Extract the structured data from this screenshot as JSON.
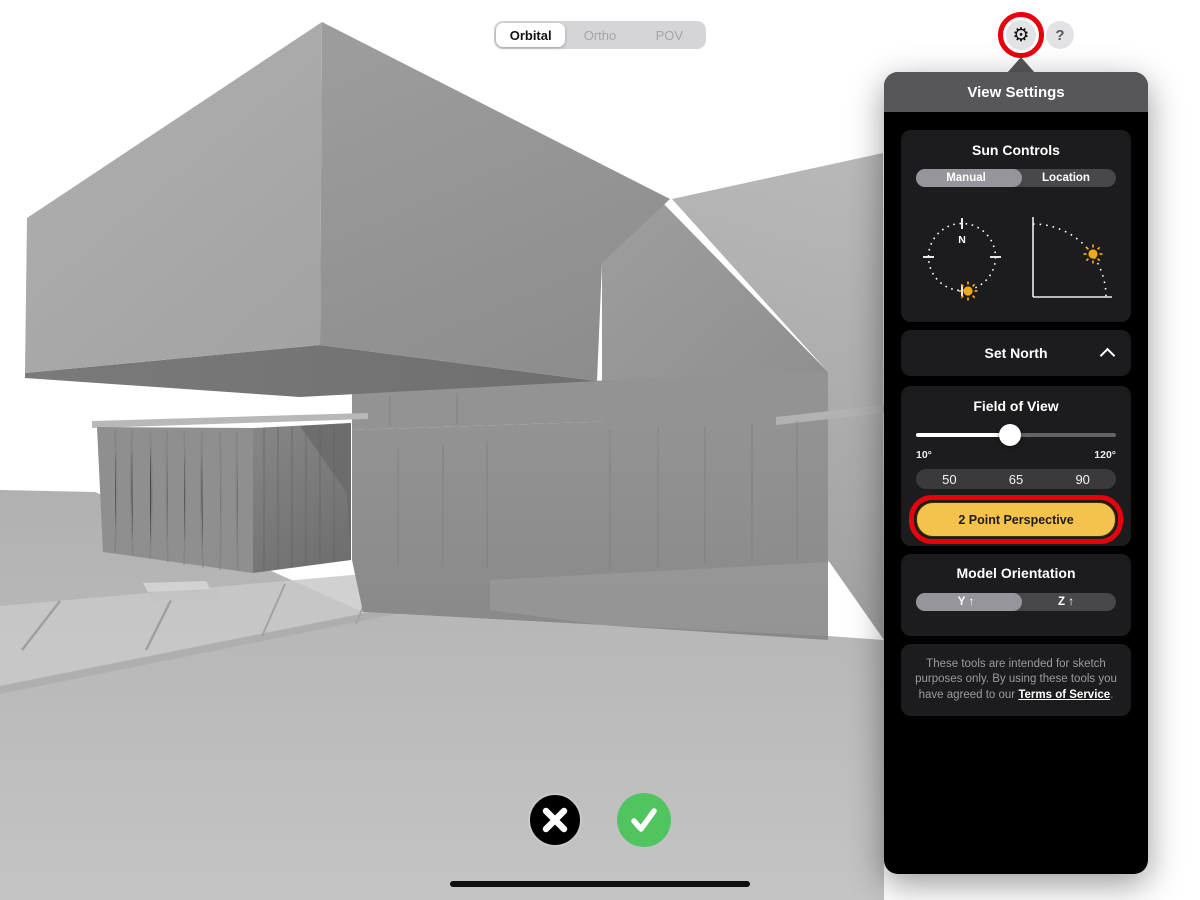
{
  "colors": {
    "annotation_red": "#E8000D",
    "accent_yellow": "#F5C24B",
    "confirm_green": "#4FC45F",
    "panel_header_gray": "#57575A",
    "card_bg": "#1C1C1E",
    "sun_yellow": "#F2A81D"
  },
  "view_mode_control": {
    "options": [
      {
        "label": "Orbital",
        "selected": true
      },
      {
        "label": "Ortho",
        "selected": false
      },
      {
        "label": "POV",
        "selected": false
      }
    ]
  },
  "toolbar": {
    "settings_icon": "gear-icon",
    "settings_char": "⚙",
    "help_icon": "question-icon",
    "help_char": "?"
  },
  "panel": {
    "title": "View Settings",
    "sun_controls": {
      "title": "Sun Controls",
      "mode_toggle": {
        "options": [
          "Manual",
          "Location"
        ],
        "selected": "Manual"
      },
      "compass_north_label": "N",
      "dials": [
        "sun-azimuth-compass-dial",
        "sun-elevation-arc-dial"
      ]
    },
    "set_north": {
      "label": "Set North",
      "collapse_icon": "chevron-up-icon"
    },
    "field_of_view": {
      "title": "Field of View",
      "min_label": "10°",
      "max_label": "120°",
      "slider_percent": 47,
      "presets": [
        "50",
        "65",
        "90"
      ],
      "perspective_button": "2 Point Perspective"
    },
    "model_orientation": {
      "title": "Model Orientation",
      "toggle": {
        "options": [
          "Y ↑",
          "Z ↑"
        ],
        "selected": "Y ↑"
      }
    },
    "disclaimer": {
      "text_before": "These tools are intended for sketch purposes only. By using these tools you have agreed to our ",
      "link_text": "Terms of Service",
      "text_after": "."
    }
  },
  "footer": {
    "cancel_icon": "x-icon",
    "confirm_icon": "check-icon"
  }
}
